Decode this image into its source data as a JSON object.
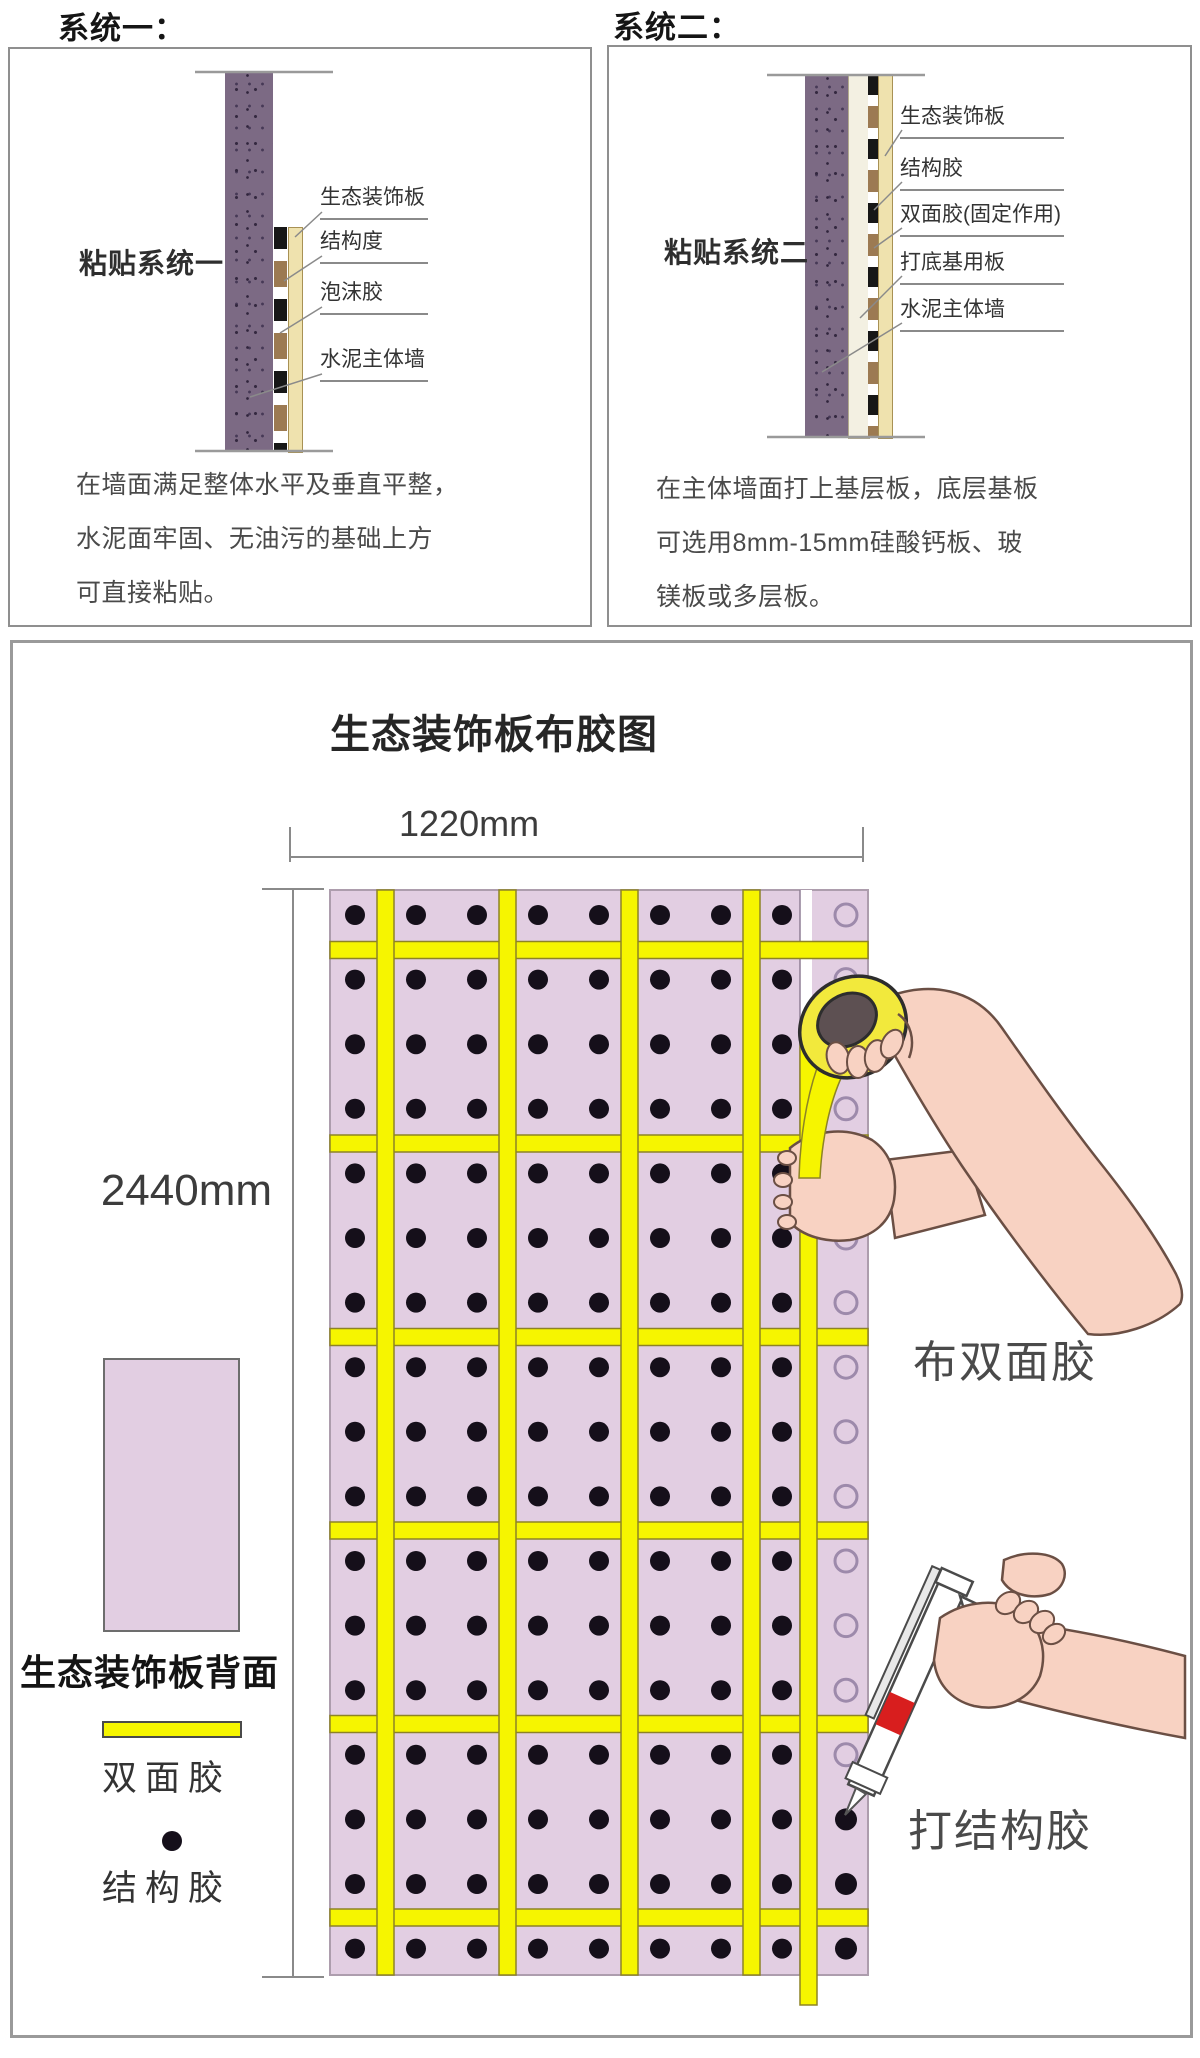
{
  "systems": [
    {
      "title": "系统一：",
      "diagram_label": "粘贴系统一",
      "layers": [
        "生态装饰板",
        "结构度",
        "泡沫胶",
        "水泥主体墙"
      ],
      "description": [
        "在墙面满足整体水平及垂直平整，",
        "水泥面牢固、无油污的基础上方",
        "可直接粘贴。"
      ]
    },
    {
      "title": "系统二：",
      "diagram_label": "粘贴系统二",
      "layers": [
        "生态装饰板",
        "结构胶",
        "双面胶(固定作用)",
        "打底基用板",
        "水泥主体墙"
      ],
      "description": [
        "在主体墙面打上基层板，底层基板",
        "可选用8mm-15mm硅酸钙板、玻",
        "镁板或多层板。"
      ]
    }
  ],
  "glue_diagram": {
    "title": "生态装饰板布胶图",
    "panel_width_label": "1220mm",
    "panel_height_label": "2440mm",
    "legend": {
      "panel_back": "生态装饰板背面",
      "tape": "双面胶",
      "glue": "结构胶"
    },
    "actions": {
      "tape": "布双面胶",
      "glue": "打结构胶"
    },
    "grid": {
      "rows": 17,
      "dot_cols": 8,
      "v_strips": 4,
      "h_strips": 6,
      "edge_open_rows": 14,
      "edge_filled_rows": 3
    },
    "colors": {
      "panel": "#e2cee2",
      "panel_border": "#ad9dad",
      "tape": "#f6f500",
      "tape_edge": "#8d8326",
      "dot": "#150f1a",
      "circle_ring": "#9d8aab",
      "boundary": "#8f7f95"
    }
  }
}
